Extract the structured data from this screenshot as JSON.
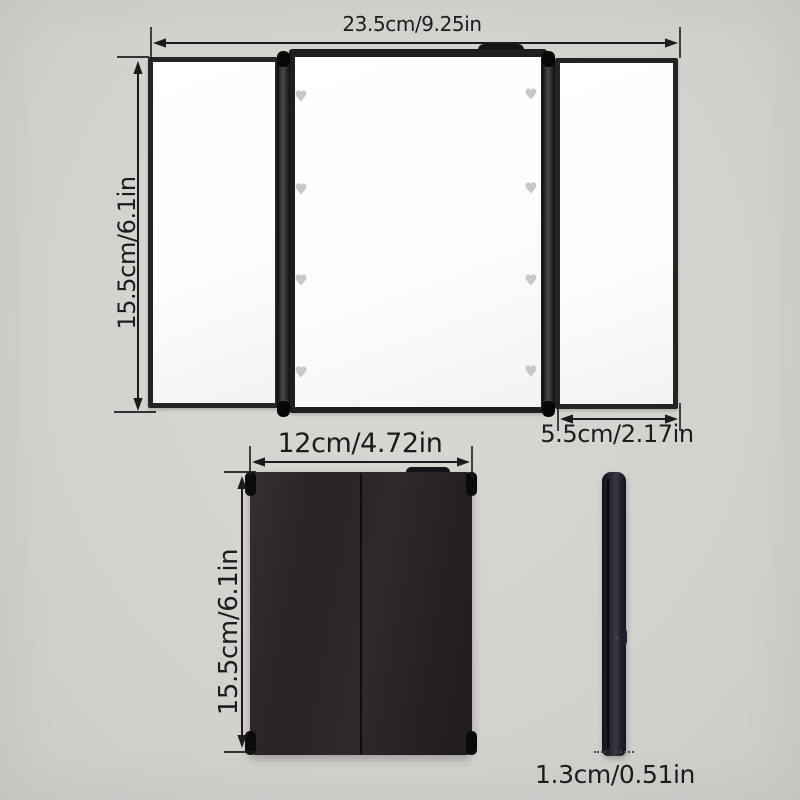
{
  "colors": {
    "background": "#d5d3cf",
    "frame_black": "#1e1e1e",
    "mirror_white": "#fdfdfd",
    "folded_body": "#2b2528",
    "dimension_ink": "#1b1b1b",
    "heart_led": "#c7c7c7"
  },
  "open_view": {
    "width_label": "23.5cm/9.25in",
    "height_label": "15.5cm/6.1in",
    "side_width_label": "5.5cm/2.17in",
    "heart_led_count": 8,
    "heart_leds_per_side": 4
  },
  "folded_front": {
    "width_label": "12cm/4.72in",
    "height_label": "15.5cm/6.1in"
  },
  "folded_side": {
    "thickness_label": "1.3cm/0.51in"
  }
}
